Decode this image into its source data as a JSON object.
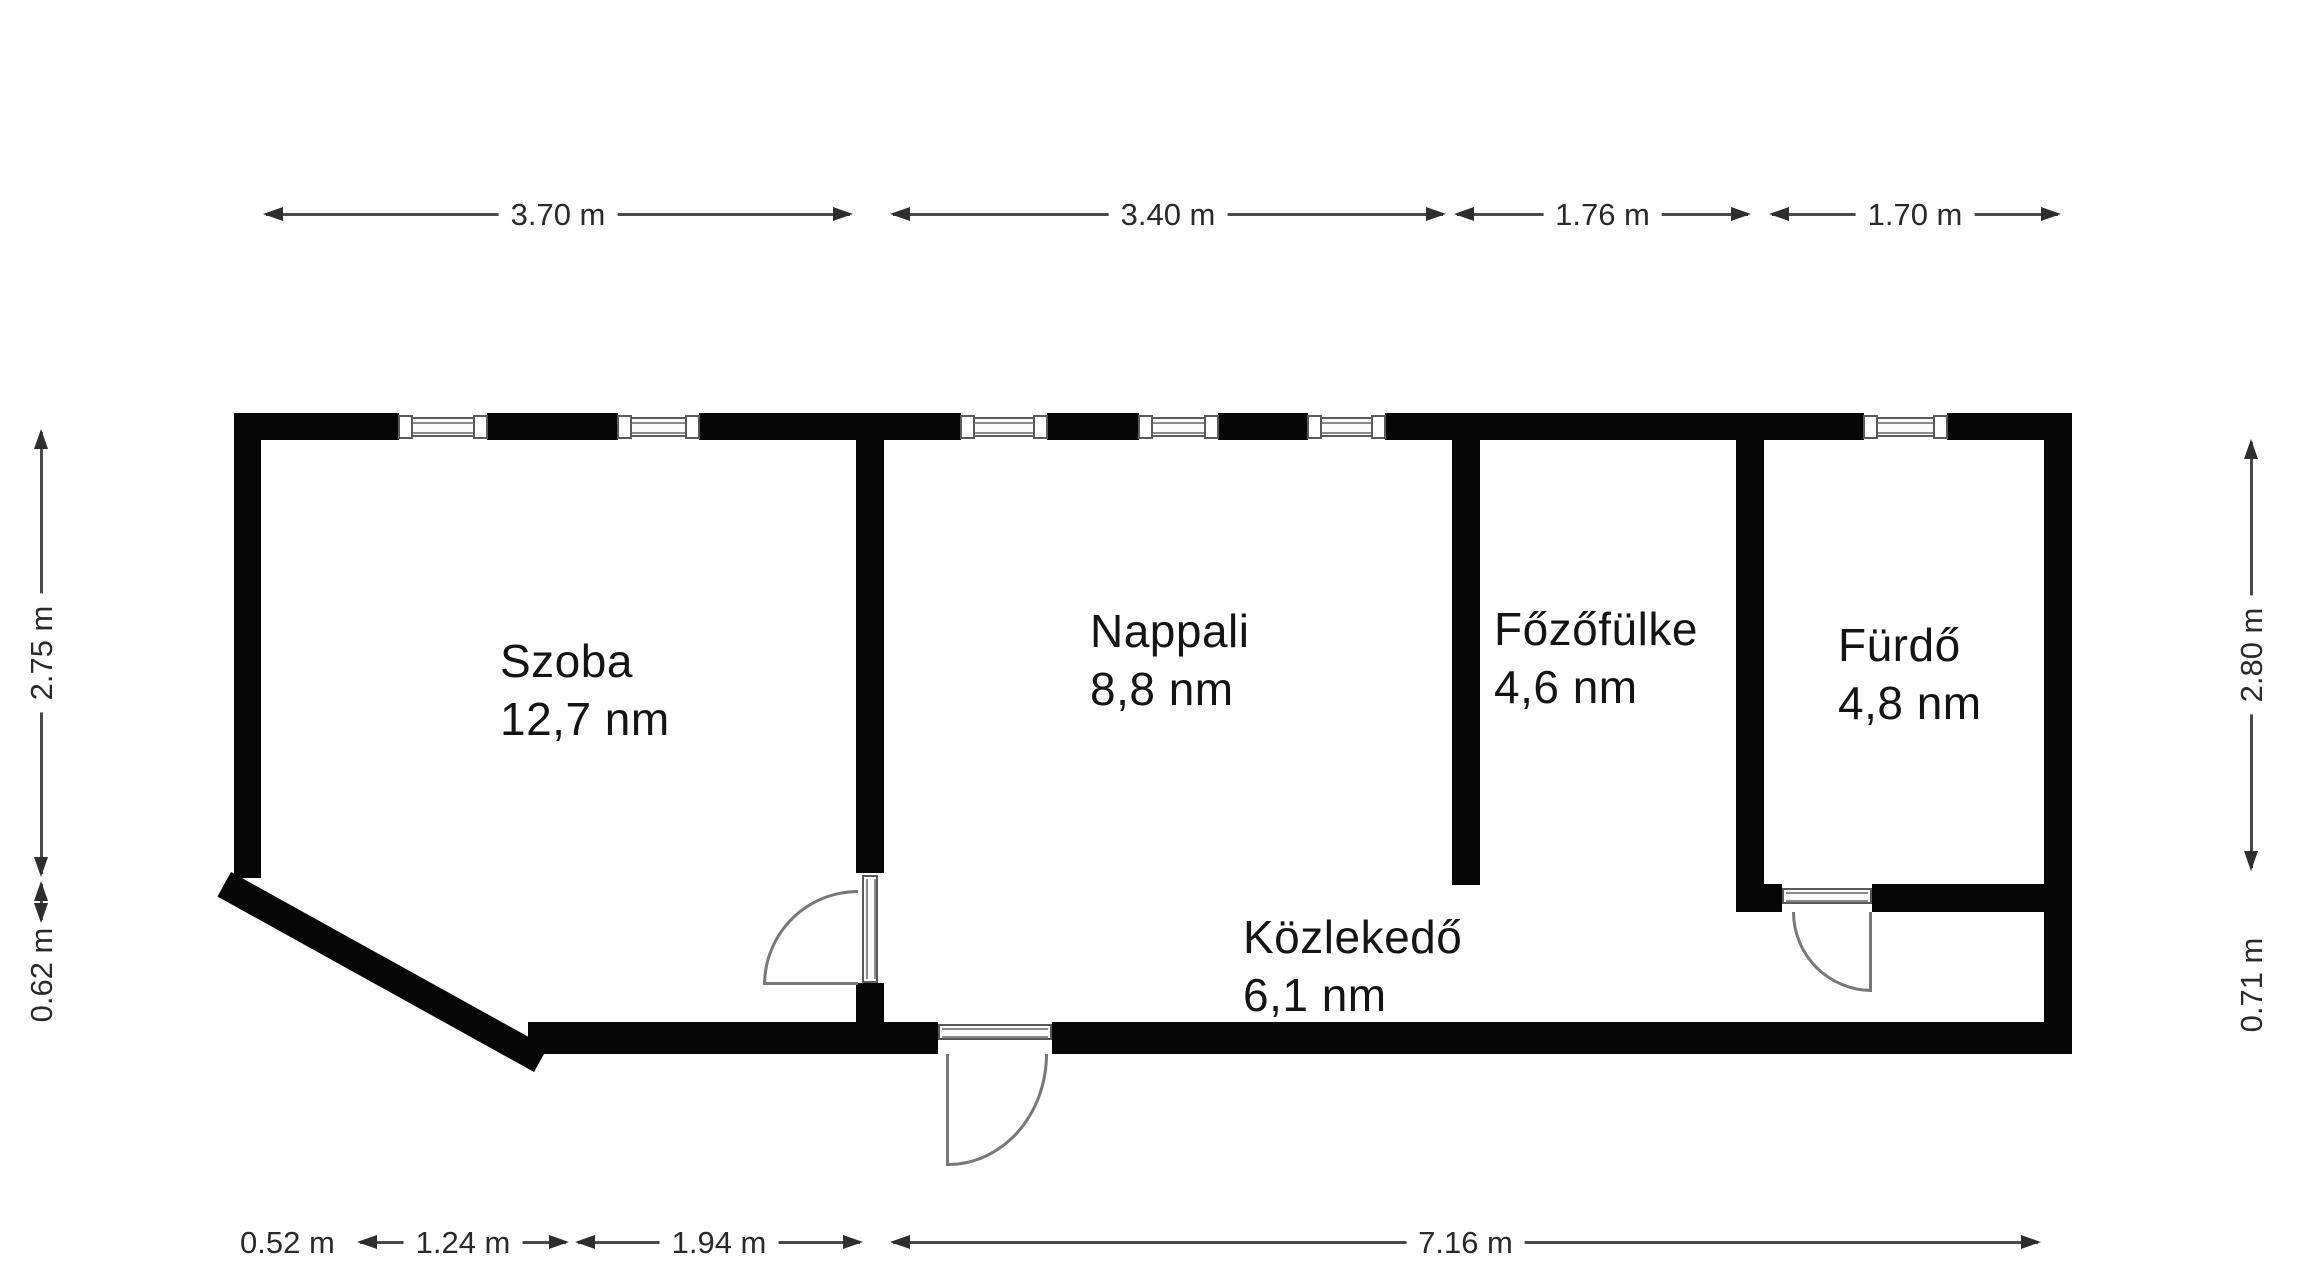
{
  "floorplan": {
    "title": "apartment-floor-plan",
    "rooms": [
      {
        "name": "Szoba",
        "area": "12,7 nm"
      },
      {
        "name": "Nappali",
        "area": "8,8 nm"
      },
      {
        "name": "Főzőfülke",
        "area": "4,6 nm"
      },
      {
        "name": "Fürdő",
        "area": "4,8 nm"
      },
      {
        "name": "Közlekedő",
        "area": "6,1 nm"
      }
    ],
    "dimensions": {
      "top": [
        "3.70 m",
        "3.40 m",
        "1.76 m",
        "1.70 m"
      ],
      "bottom": [
        "0.52 m",
        "1.24 m",
        "1.94 m",
        "7.16 m"
      ],
      "left": [
        "2.75 m",
        "0.62 m"
      ],
      "right": [
        "2.80 m",
        "0.71 m"
      ]
    },
    "colors": {
      "wall": "#060606",
      "background": "#ffffff",
      "dimension_line": "#4a4a4a",
      "dimension_text": "#2a2a2a",
      "door": "#787878",
      "window_frame": "#5a5a5a"
    }
  }
}
